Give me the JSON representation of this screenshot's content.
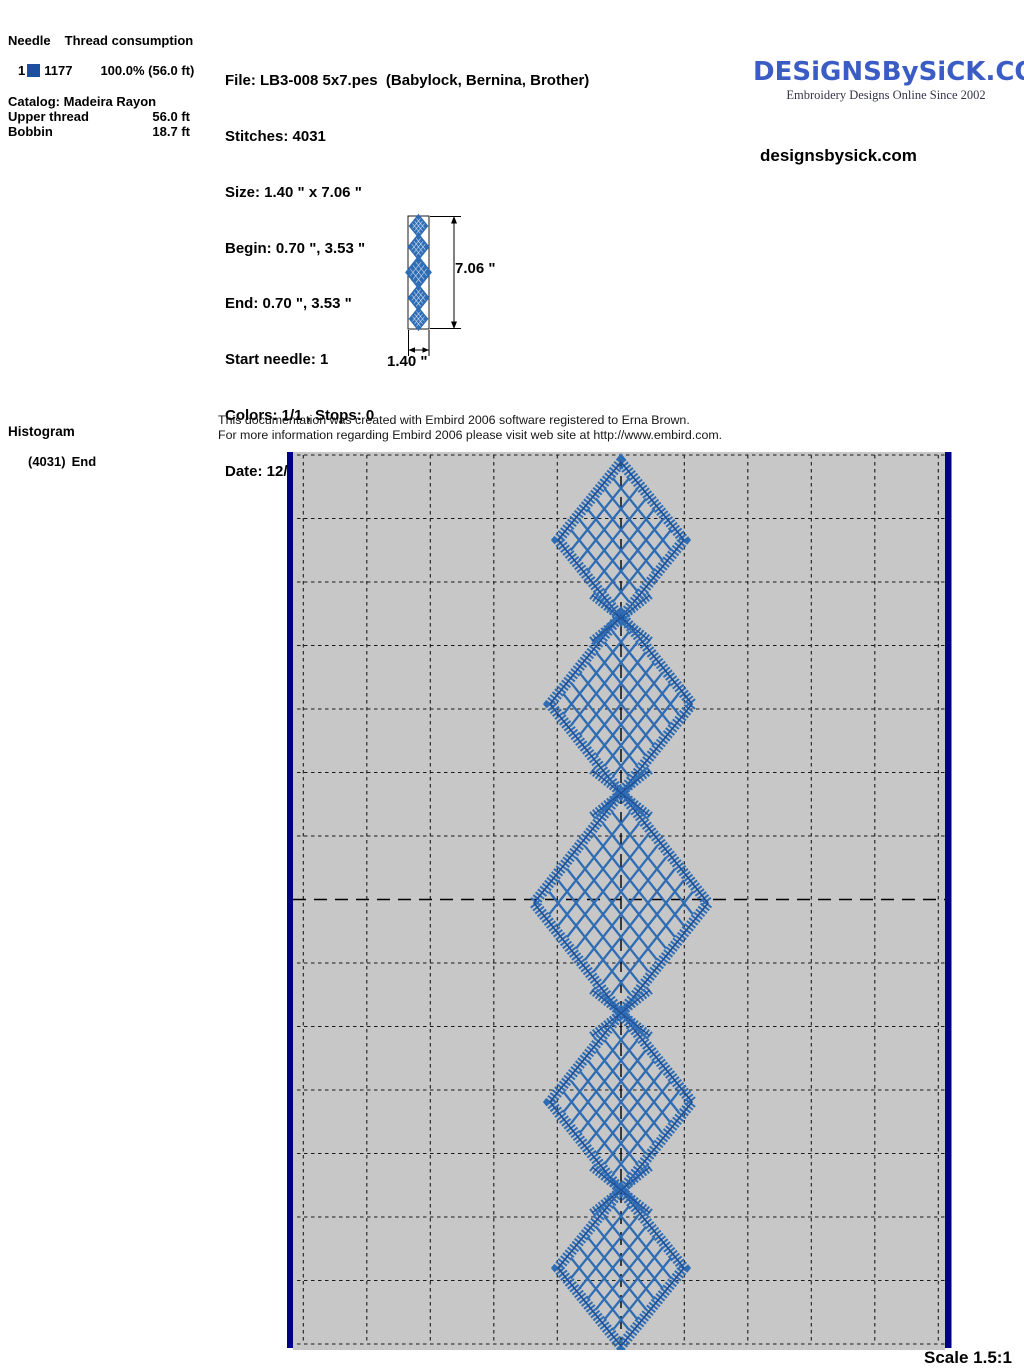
{
  "thread_table": {
    "header_needle": "Needle",
    "header_consumption": "Thread consumption",
    "row": {
      "needle": "1",
      "swatch_color": "#1d4fa1",
      "thread_code": "1177",
      "consumption": "100.0% (56.0 ft)"
    },
    "catalog": "Catalog: Madeira Rayon",
    "upper_thread_label": "Upper thread",
    "upper_thread_value": "56.0 ft",
    "bobbin_label": "Bobbin",
    "bobbin_value": "18.7 ft"
  },
  "file_info": {
    "lines": [
      "File: LB3-008 5x7.pes  (Babylock, Bernina, Brother)",
      "Stitches: 4031",
      "Size: 1.40 \" x 7.06 \"",
      "Begin: 0.70 \", 3.53 \"",
      "End: 0.70 \", 3.53 \"",
      "Start needle: 1",
      "Colors: 1/1 , Stops: 0",
      "Date: 12/31/2007"
    ]
  },
  "brand": {
    "logo_text": "DESiGNSBySiCK.COM",
    "tagline": "Embroidery Designs Online Since 2002",
    "website": "designsbysick.com",
    "logo_color": "#3b5cc4"
  },
  "preview": {
    "height_label": "7.06 \"",
    "width_label": "1.40 \""
  },
  "histogram": {
    "title": "Histogram",
    "count": "(4031)",
    "label": "End"
  },
  "note": {
    "line1": "This documentation was created with Embird 2006 software registered to Erna Brown.",
    "line2": "For more information regarding Embird 2006 please visit web site at http://www.embird.com."
  },
  "footer": {
    "scale": "Scale 1.5:1"
  },
  "design": {
    "stitch_color": "#2e6cb4",
    "stitch_dark": "#1f4f96",
    "canvas_bg": "#c7c7c7",
    "edge_bar_color": "#000082",
    "grid_line_color": "#1a1a1a",
    "diamond_count": 5,
    "diamonds": [
      {
        "cx": 334,
        "cy": 88,
        "hw": 63,
        "hh": 78,
        "lattice": 6
      },
      {
        "cx": 334,
        "cy": 252,
        "hw": 71,
        "hh": 89,
        "lattice": 7
      },
      {
        "cx": 334,
        "cy": 451,
        "hw": 87,
        "hh": 110,
        "lattice": 8
      },
      {
        "cx": 334,
        "cy": 650,
        "hw": 71,
        "hh": 89,
        "lattice": 7
      },
      {
        "cx": 334,
        "cy": 816,
        "hw": 63,
        "hh": 78,
        "lattice": 6
      }
    ],
    "crossings_y": [
      166,
      341,
      561,
      738
    ],
    "center_x": 334,
    "axis_row_y": 447.5
  }
}
